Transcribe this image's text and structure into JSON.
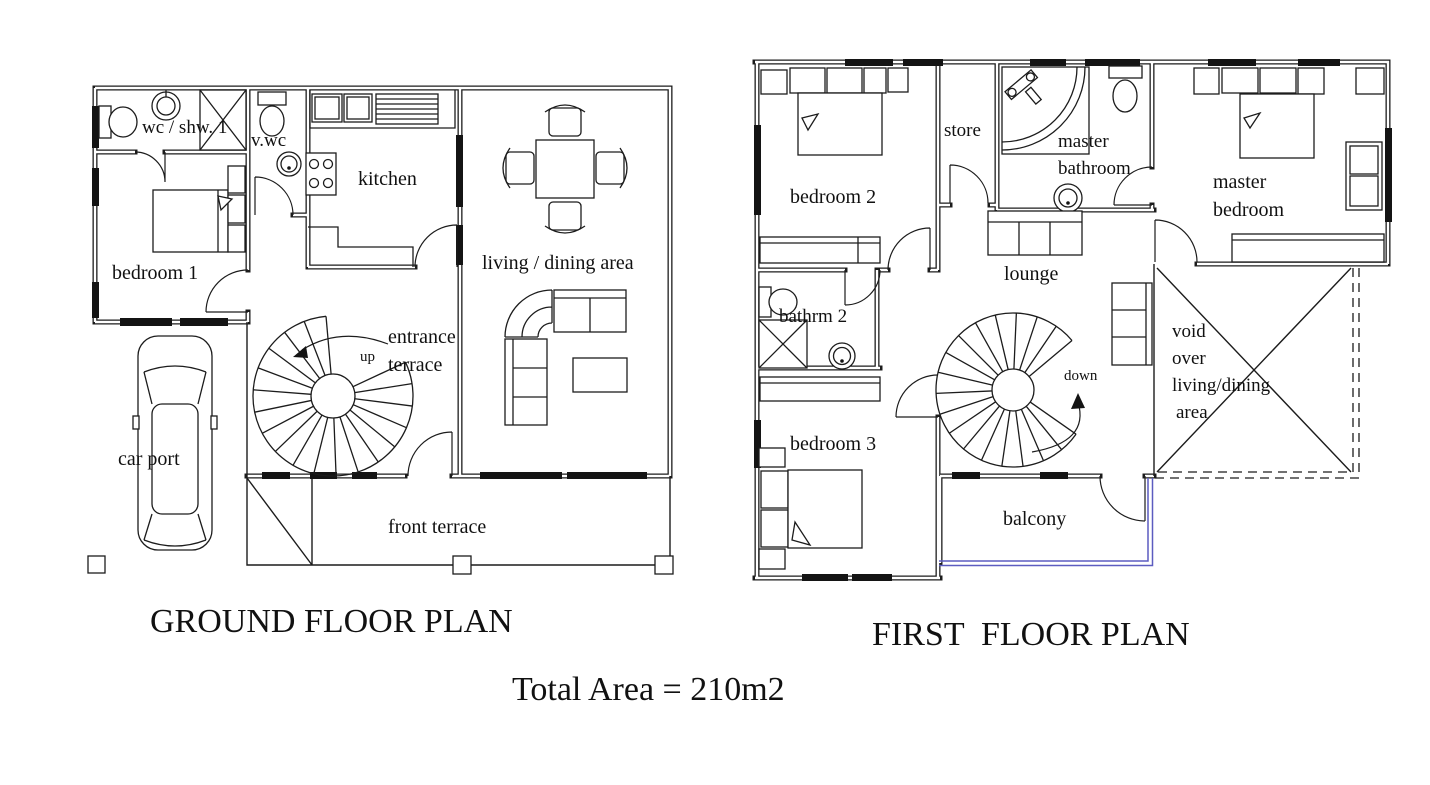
{
  "colors": {
    "line": "#1c1c1c",
    "balcony_edge": "#5c5cc0",
    "background": "#ffffff"
  },
  "titles": {
    "ground": "GROUND FLOOR PLAN",
    "first": "FIRST  FLOOR PLAN",
    "total_area": "Total Area = 210m2"
  },
  "ground_floor": {
    "rooms": {
      "wc_shw": "wc / shw. 1",
      "v_wc": "v.wc",
      "kitchen": "kitchen",
      "living_dining": "living / dining area",
      "bedroom1": "bedroom 1",
      "entrance1": "entrance",
      "entrance2": "terrace",
      "up": "up",
      "car_port": "car port",
      "front_terrace": "front terrace"
    }
  },
  "first_floor": {
    "rooms": {
      "bedroom2": "bedroom 2",
      "store": "store",
      "master_bath1": "master",
      "master_bath2": "bathroom",
      "master_bed1": "master",
      "master_bed2": "bedroom",
      "lounge": "lounge",
      "bathrm2": "bathrm 2",
      "bedroom3": "bedroom 3",
      "down": "down",
      "void1": "void",
      "void2": "over",
      "void3": "living/dining",
      "void4": "area",
      "balcony": "balcony"
    }
  }
}
